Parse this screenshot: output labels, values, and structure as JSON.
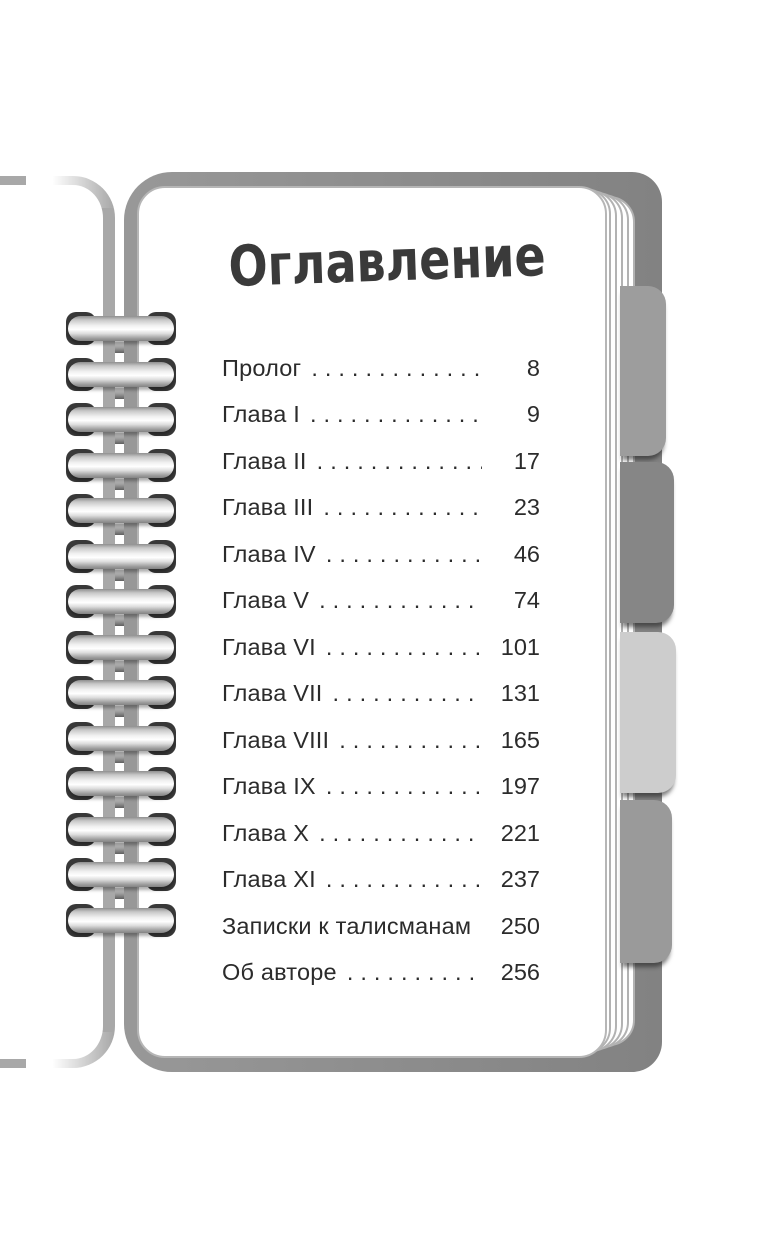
{
  "page_title": "Оглавление",
  "toc": {
    "entries": [
      {
        "label": "Пролог",
        "page": "8"
      },
      {
        "label": "Глава I",
        "page": "9"
      },
      {
        "label": "Глава II",
        "page": "17"
      },
      {
        "label": "Глава III",
        "page": "23"
      },
      {
        "label": "Глава IV",
        "page": "46"
      },
      {
        "label": "Глава V",
        "page": "74"
      },
      {
        "label": "Глава VI",
        "page": "101"
      },
      {
        "label": "Глава VII",
        "page": "131"
      },
      {
        "label": "Глава VIII",
        "page": "165"
      },
      {
        "label": "Глава IX",
        "page": "197"
      },
      {
        "label": "Глава X",
        "page": "221"
      },
      {
        "label": "Глава XI",
        "page": "237"
      },
      {
        "label": "Записки к талисманам",
        "page": "250"
      },
      {
        "label": "Об авторе",
        "page": "256"
      }
    ]
  },
  "notebook": {
    "cover_color": "#8d8d8d",
    "back_sheet_edge_color": "#a8a8a8",
    "tabs": [
      {
        "name": "tab-1",
        "color": "#9d9d9d"
      },
      {
        "name": "tab-2",
        "color": "#868686"
      },
      {
        "name": "tab-3",
        "color": "#cdcdcd"
      },
      {
        "name": "tab-4",
        "color": "#9a9a9a"
      }
    ]
  }
}
